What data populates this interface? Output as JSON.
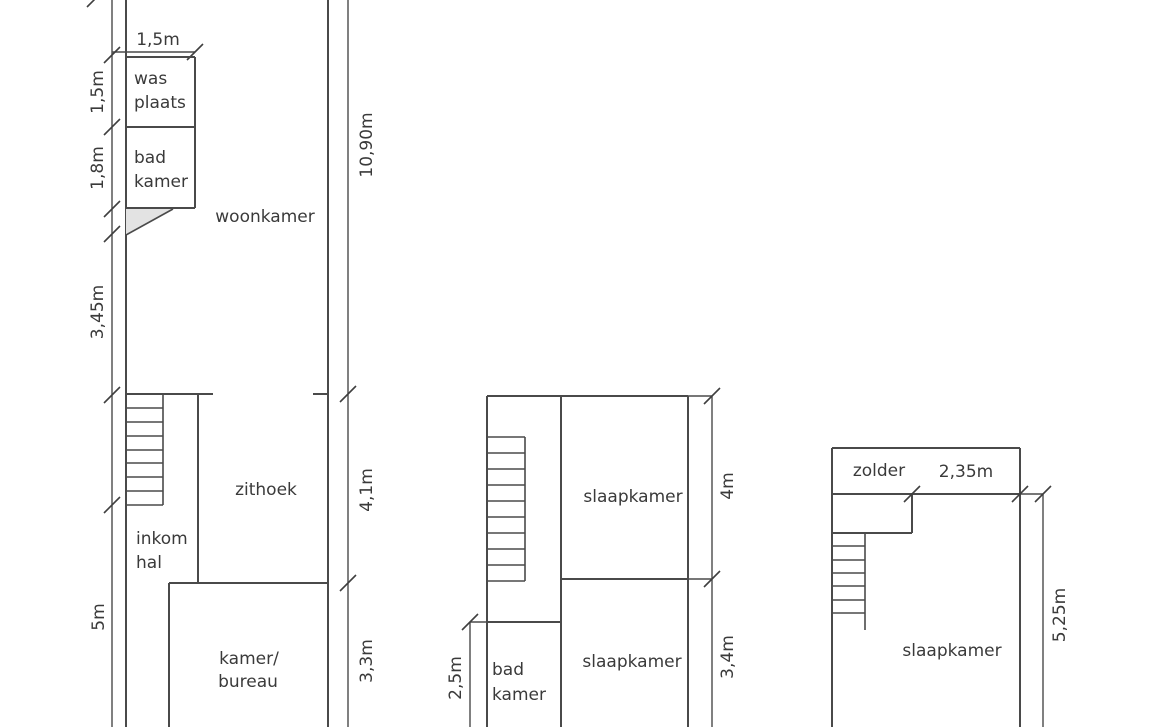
{
  "colors": {
    "line": "#4a4a4a",
    "text": "#3a3a3a",
    "shade_fill": "#e3e3e3",
    "background": "#ffffff"
  },
  "plans": {
    "ground_floor": {
      "rooms": {
        "wasplaats": {
          "line1": "was",
          "line2": "plaats"
        },
        "badkamer": {
          "line1": "bad",
          "line2": "kamer"
        },
        "woonkamer": "woonkamer",
        "zithoek": "zithoek",
        "inkomhal": {
          "line1": "inkom",
          "line2": "hal"
        },
        "kamer_bureau": {
          "line1": "kamer/",
          "line2": "bureau"
        }
      },
      "dimensions": {
        "top_width": "1,5m",
        "left_1": "1,5m",
        "left_2": "1,8m",
        "left_3": "3,45m",
        "left_4": "5m",
        "right_total": "10,90m",
        "right_mid": "4,1m",
        "right_bottom": "3,3m"
      }
    },
    "first_floor": {
      "rooms": {
        "slaapkamer_front": "slaapkamer",
        "slaapkamer_back": "slaapkamer",
        "badkamer": {
          "line1": "bad",
          "line2": "kamer"
        }
      },
      "dimensions": {
        "right_top": "4m",
        "right_bottom": "3,4m",
        "left": "2,5m"
      }
    },
    "attic_floor": {
      "rooms": {
        "zolder": "zolder",
        "slaapkamer": "slaapkamer"
      },
      "dimensions": {
        "top_width": "2,35m",
        "right": "5,25m"
      }
    }
  }
}
